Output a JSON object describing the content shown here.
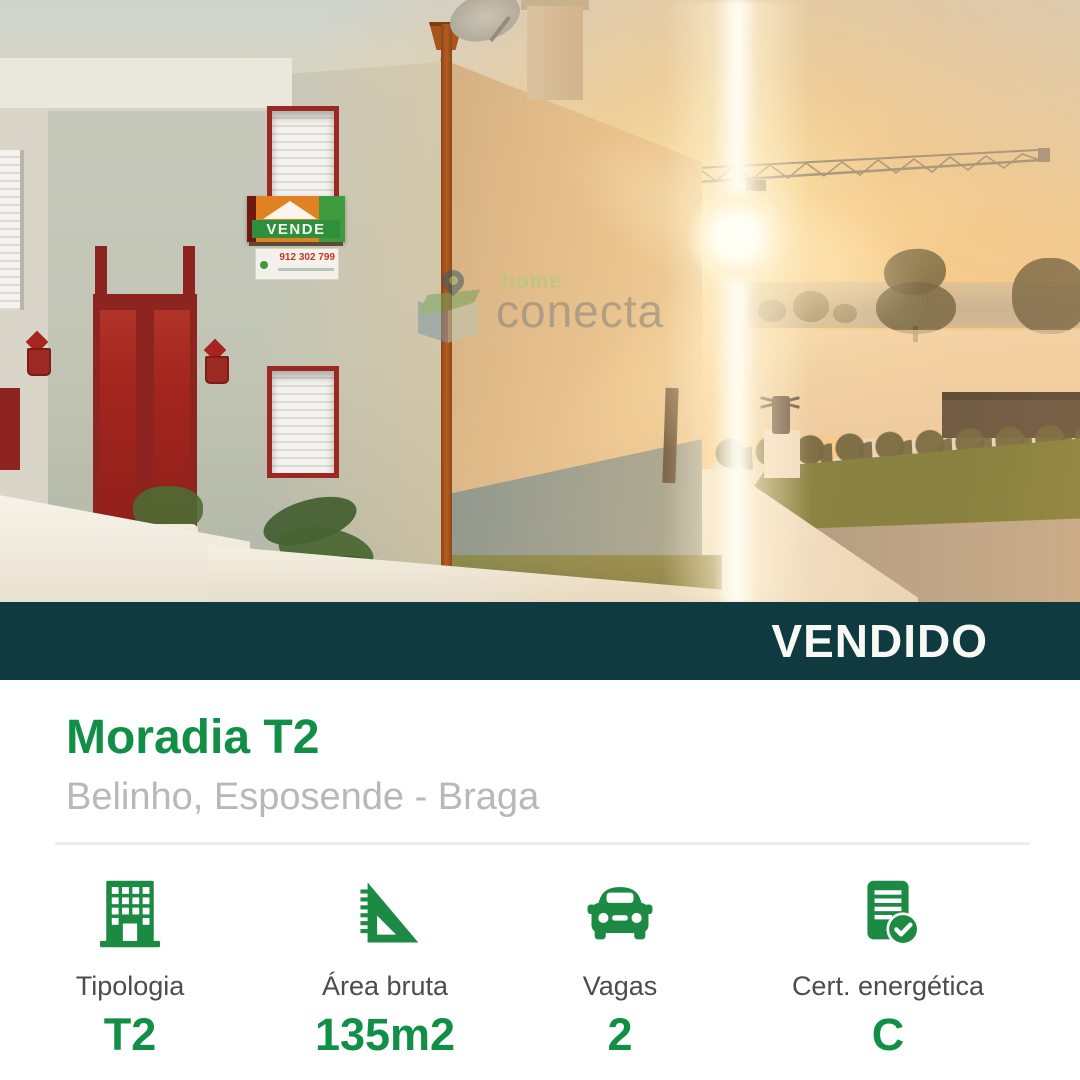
{
  "photo": {
    "watermark": {
      "brand_top": "home",
      "brand": "conecta"
    },
    "sale_sign": {
      "label": "VENDE",
      "phone": "912 302 799"
    }
  },
  "banner": {
    "status": "VENDIDO"
  },
  "listing": {
    "title": "Moradia T2",
    "location": "Belinho, Esposende - Braga"
  },
  "features": [
    {
      "icon": "building-icon",
      "label": "Tipologia",
      "value": "T2"
    },
    {
      "icon": "set-square-icon",
      "label": "Área bruta",
      "value": "135m2"
    },
    {
      "icon": "car-icon",
      "label": "Vagas",
      "value": "2"
    },
    {
      "icon": "certificate-check-icon",
      "label": "Cert. energética",
      "value": "C"
    }
  ],
  "colors": {
    "accent_green": "#118f46",
    "banner_teal": "#0f3a40",
    "label_gray": "#4c4c4c",
    "location_gray": "#b8b8b8"
  }
}
